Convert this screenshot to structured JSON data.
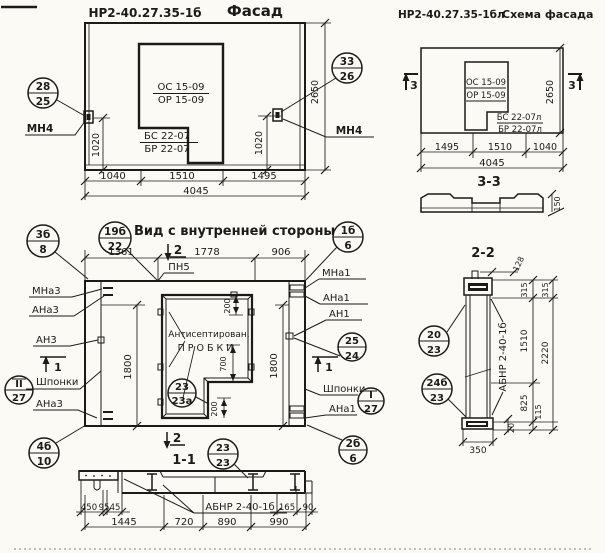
{
  "facade": {
    "code": "НР2-40.27.35-1б",
    "title": "Фасад",
    "callout_left": {
      "top": "28",
      "bottom": "25"
    },
    "callout_right": {
      "top": "33",
      "bottom": "26"
    },
    "anchor_label_left": "МН4",
    "anchor_label_right": "МН4",
    "opening": {
      "line1": "ОС 15-09",
      "line2": "ОР 15-09",
      "line3": "БС 22-07",
      "line4": "БР 22-07"
    },
    "dims": {
      "v_left": "1020",
      "v_right": "1020",
      "height": "2650",
      "w1": "1040",
      "w2": "1510",
      "w3": "1495",
      "total": "4045"
    }
  },
  "schema": {
    "code": "НР2-40.27.35-1бл",
    "title": "Схема фасада",
    "section_mark": "3",
    "opening": {
      "line1": "ОС 15-09",
      "line2": "ОР 15-09",
      "line3": "БС 22-07л",
      "line4": "БР 22-07л"
    },
    "dims": {
      "height": "2650",
      "w1": "1495",
      "w2": "1510",
      "w3": "1040",
      "total": "4045"
    },
    "section": {
      "title": "3-3",
      "thickness": "150"
    }
  },
  "inner": {
    "title": "Вид с внутренней стороны",
    "section_title": "1-1",
    "callouts": {
      "c3b8": {
        "top": "3б",
        "bottom": "8"
      },
      "c19b22": {
        "top": "19б",
        "bottom": "22"
      },
      "c1b6": {
        "top": "1б",
        "bottom": "6"
      },
      "c2524": {
        "top": "25",
        "bottom": "24"
      },
      "c27l": {
        "top": "II",
        "bottom": "27"
      },
      "c27r": {
        "top": "I",
        "bottom": "27"
      },
      "c4b10": {
        "top": "4б",
        "bottom": "10"
      },
      "c2b6": {
        "top": "2б",
        "bottom": "6"
      },
      "c2323a": {
        "top": "23",
        "bottom": "23а"
      },
      "c2323": {
        "top": "23",
        "bottom": "23"
      }
    },
    "labels": {
      "pn5": "ПН5",
      "mna3": "МНа3",
      "ana3": "АНа3",
      "an3": "АН3",
      "shponki_left": "Шпонки",
      "ana3_b": "АНа3",
      "mna1": "МНа1",
      "ana1": "АНа1",
      "an1": "АН1",
      "shponki_right": "Шпонки",
      "ana1_b": "АНа1",
      "antiseptic_line1": "Антисептирован.",
      "antiseptic_line2": "ПРОБКИ"
    },
    "marks": {
      "m2_top": "2",
      "m1_left": "1",
      "m1_right": "1",
      "m2_bottom": "2"
    },
    "dims": {
      "w1": "1361",
      "w2": "1778",
      "w3": "906",
      "v_left": "1800",
      "v_right": "1800",
      "plug_top": "200",
      "step": "700",
      "plug_bottom": "200"
    }
  },
  "section11": {
    "label": "АБНР 2-40-1б",
    "dims": {
      "d450": "450",
      "d95": "95",
      "d45": "45",
      "d165": "165",
      "d90": "90",
      "w1445": "1445",
      "w720": "720",
      "w890": "890",
      "w990": "990"
    }
  },
  "section22": {
    "title": "2-2",
    "label": "АБНР 2-40-1б",
    "callout_top": {
      "top": "20",
      "bottom": "23"
    },
    "callout_bottom": {
      "top": "24б",
      "bottom": "23"
    },
    "dims": {
      "offset": "128",
      "t_inner": "315",
      "t_outer": "315",
      "mid": "1510",
      "total": "2220",
      "low": "825",
      "base": "115",
      "width": "350",
      "shoe": "20"
    }
  },
  "colors": {
    "ink": "#1d1b18",
    "paper": "#fbfaf5"
  }
}
